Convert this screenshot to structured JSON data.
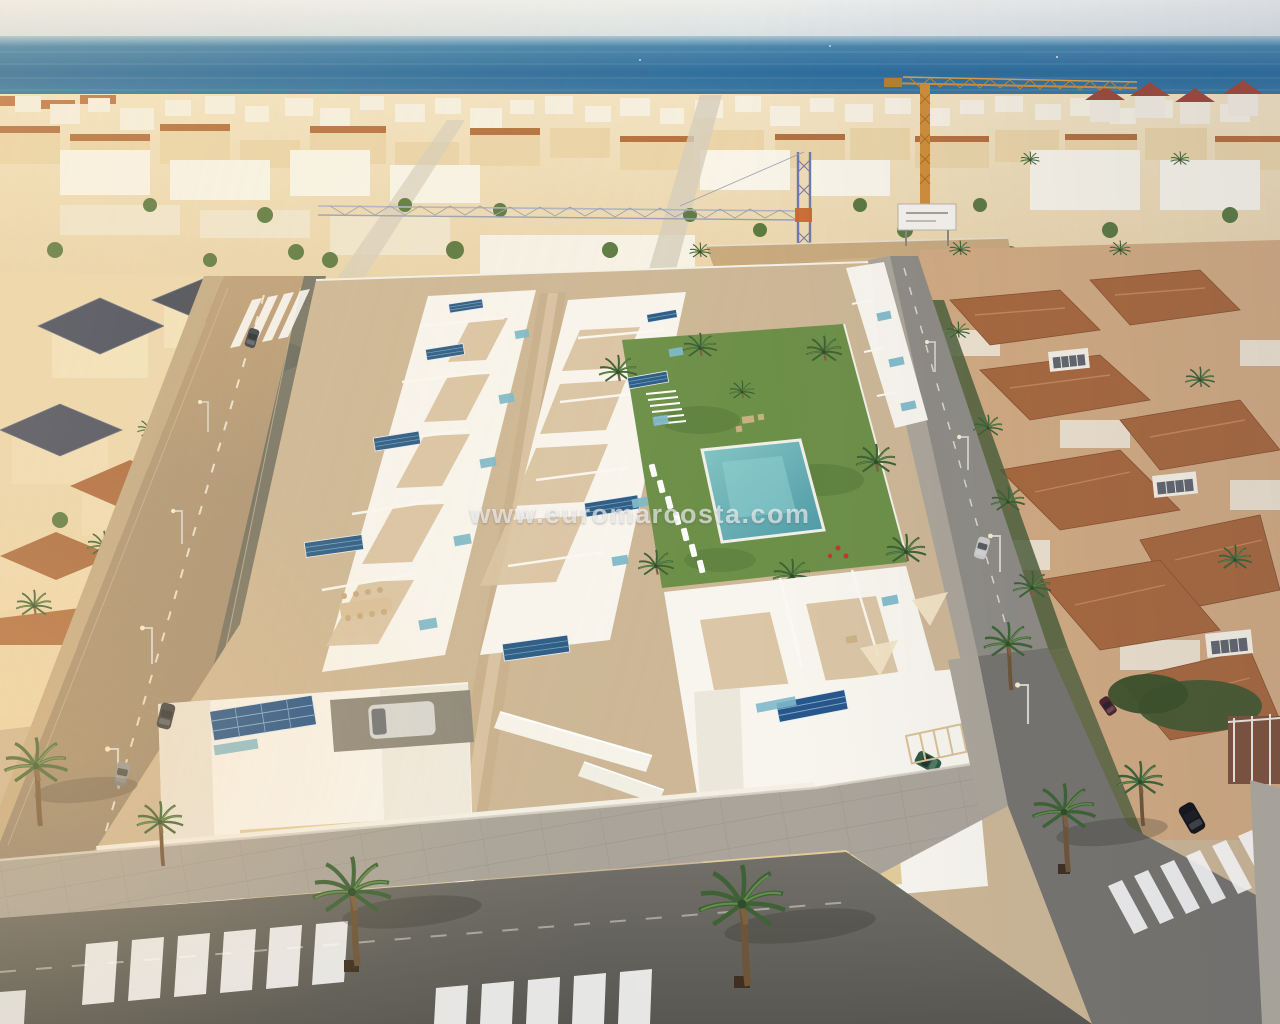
{
  "image": {
    "type": "aerial-3d-render",
    "subject": "Aerial render of a new beachside residential development of white villas with solar panels and a communal pool, surrounded by an existing Mediterranean coastal town"
  },
  "watermark": {
    "text": "www.euromarcosta.com",
    "color": "#ffffff",
    "opacity": 0.62
  },
  "scene": {
    "elements": [
      "sky",
      "sea",
      "coastal-town-skyline",
      "yellow-tower-crane",
      "blue-tower-crane",
      "vacant-sandy-lot",
      "billboard",
      "left-villa-district",
      "right-terracotta-villa-district",
      "new-white-villa-rows",
      "rooftop-solar-panels",
      "teal-glass-balustrades",
      "communal-lawn-garden",
      "swimming-pool",
      "sun-loungers",
      "pergola",
      "central-walkway",
      "external-stairs",
      "stone-clad-facades",
      "carport-van",
      "left-avenue",
      "right-street",
      "bottom-street",
      "paved-sidewalk",
      "zebra-crosswalks",
      "street-lamps",
      "parked-cars",
      "palm-trees"
    ]
  },
  "palette": {
    "sky_top": "#ecedec",
    "sky_bottom": "#d8dee2",
    "sea_deep": "#2d6d9c",
    "sea_light": "#a9c6d4",
    "town_white": "#f6f0e1",
    "town_beige": "#ead4a8",
    "roof_terracotta": "#a8693e",
    "roof_slate": "#474c5e",
    "villa_white": "#f8f5ee",
    "terrace_tan": "#d9c3a2",
    "ground_tan": "#cdb796",
    "solar_panel_blue": "#2d5c85",
    "glass_teal": "#7fb9c9",
    "pool_turquoise": "#5fa8ab",
    "lawn_green": "#6d9049",
    "palm_green": "#3e6236",
    "trunk_brown": "#7d6242",
    "asphalt": "#6f6e68",
    "avenue_tan": "#bb9f7b",
    "sidewalk_gray": "#aaa49a",
    "sand_lot": "#c9aa7e",
    "crane_yellow": "#d2903c",
    "crane_blue": "#7079a8"
  }
}
